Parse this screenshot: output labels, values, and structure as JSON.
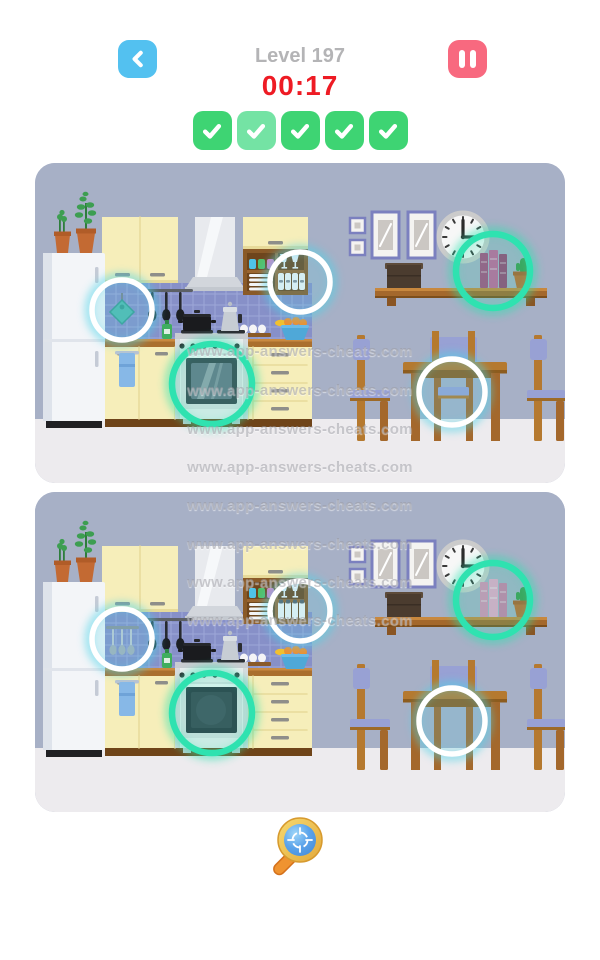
{
  "header": {
    "back_icon": "chevron-left-icon",
    "back_button_color": "#53c1f0",
    "level_label": "Level 197",
    "timer": "00:17",
    "timer_color": "#ee1b24",
    "pause_icon": "pause-icon",
    "pause_button_color": "#f8697f"
  },
  "progress": {
    "found": 5,
    "total": 5,
    "check_icon": "checkmark-icon",
    "tile_colors": [
      "#3ed473",
      "#74e3a4",
      "#3ed473",
      "#3ed473",
      "#3ed473"
    ]
  },
  "watermark": {
    "text": "www.app-answers-cheats.com",
    "row_y": [
      352,
      391,
      430,
      468,
      506,
      545,
      583,
      621
    ]
  },
  "scene": {
    "description": "spot-the-difference kitchen scene, top and bottom copies",
    "wall_color": "#a7b0c6",
    "floor_color": "#edebee",
    "panels": [
      {
        "id": "top",
        "variant": "A"
      },
      {
        "id": "bottom",
        "variant": "B"
      }
    ]
  },
  "differences": [
    {
      "id": "tile-wall-item",
      "x": 87,
      "y": 147,
      "r": 30,
      "ring": "cyan",
      "top": "teal pot holder on tiles",
      "bottom": "hanging silver ladles"
    },
    {
      "id": "cupboard-glassware",
      "x": 265,
      "y": 119,
      "r": 30,
      "ring": "cyan",
      "top": "jars with label bands",
      "bottom": "jars with dark lids"
    },
    {
      "id": "oven-door",
      "x": 177,
      "y": 221,
      "r": 40,
      "ring": "green",
      "top": "glass oven door with shine",
      "bottom": "dark oven door"
    },
    {
      "id": "shelf-books",
      "x": 458,
      "y": 108,
      "r": 37,
      "ring": "green",
      "top": "dark magenta books",
      "bottom": "light pink books"
    },
    {
      "id": "chair-under-table",
      "x": 417,
      "y": 229,
      "r": 33,
      "ring": "cyan",
      "top": "chair seat visible",
      "bottom": "chair seat missing"
    }
  ],
  "ring_colors": {
    "cyan_ring": "#ffffff",
    "cyan_glow": "#4fd4e8",
    "green_ring": "#2fe2b0"
  },
  "hint": {
    "icon": "magnifier-target-icon"
  }
}
